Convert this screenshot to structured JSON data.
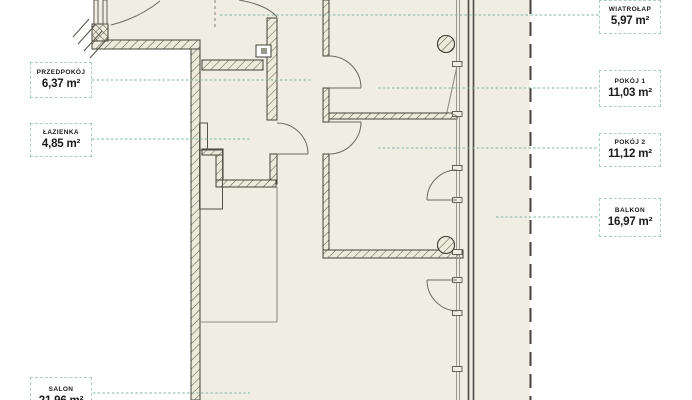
{
  "plan": {
    "labels": [
      {
        "name": "WIATROŁAP",
        "area": "5,97 m²"
      },
      {
        "name": "PRZEDPOKÓJ",
        "area": "6,37 m²"
      },
      {
        "name": "ŁAZIENKA",
        "area": "4,85 m²"
      },
      {
        "name": "POKÓJ 1",
        "area": "11,03 m²"
      },
      {
        "name": "POKÓJ 2",
        "area": "11,12 m²"
      },
      {
        "name": "BALKON",
        "area": "16,97 m²"
      },
      {
        "name": "SALON",
        "area": "21,96 m²"
      }
    ],
    "colors": {
      "page_bg": "#ffffff",
      "floor": "#f0eee2",
      "wall_dark": "#44423a",
      "leader_teal": "#7cb7a5",
      "tag_border": "#a9cec3",
      "text": "#1b1b1b"
    }
  }
}
